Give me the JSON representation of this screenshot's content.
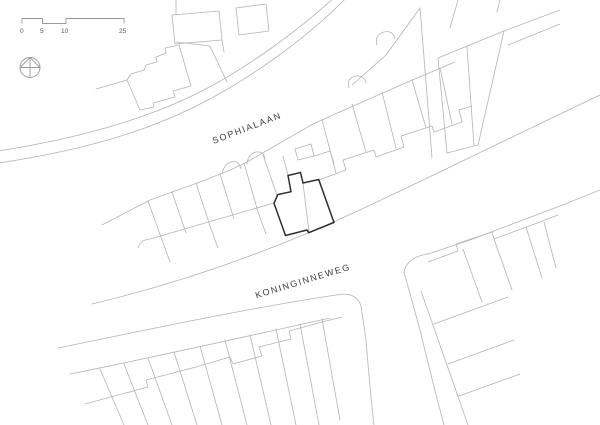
{
  "canvas": {
    "background": "#ffffff"
  },
  "colors": {
    "plot_line": "#b3b3b3",
    "subject_outline": "#2e2e2e",
    "label_text": "#3d3d3d",
    "scalebar_line": "#9a9a9a"
  },
  "scalebar": {
    "ticks": [
      "0",
      "5",
      "10",
      "25"
    ]
  },
  "streets": {
    "sophialaan": "SOPHIALAAN",
    "koninginneweg": "KONINGINNEWEG"
  },
  "icons": {
    "north_indicator": "compass-circle-with-north-triangle"
  }
}
